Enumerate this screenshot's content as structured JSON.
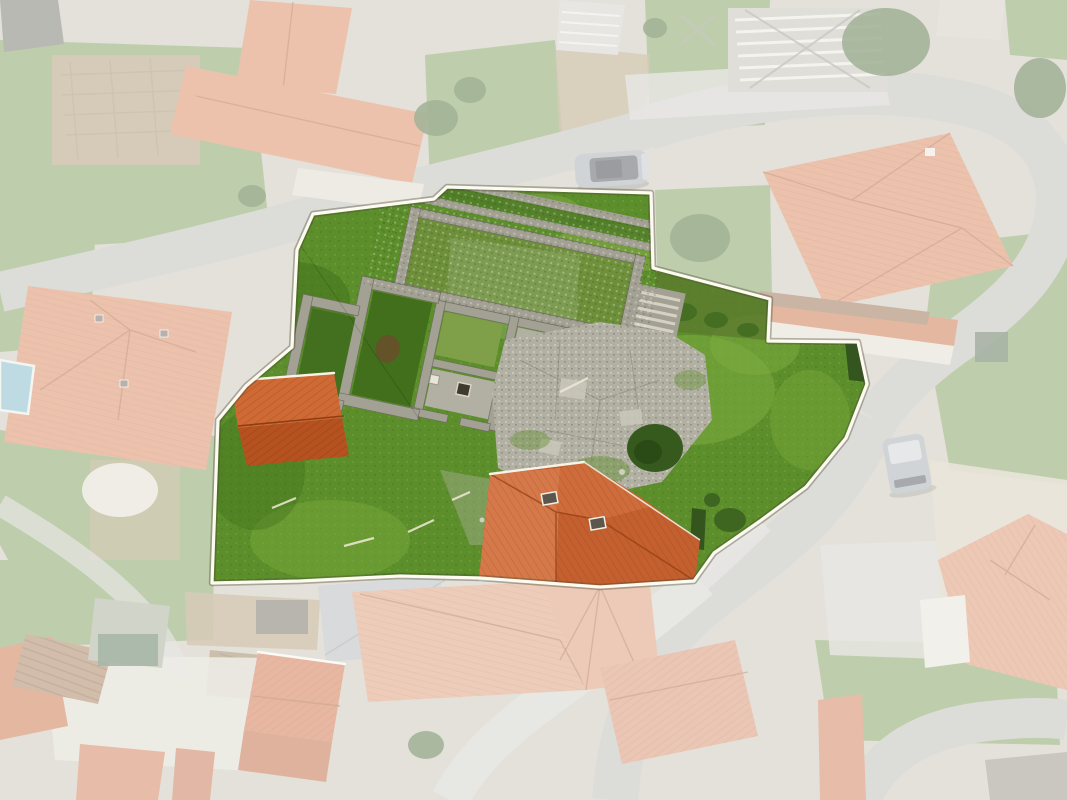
{
  "scene": {
    "type": "aerial-drone-photograph",
    "subject": "Top-down drone photo of a village; a property parcel with stone ruins and lawns is highlighted by a white boundary line while all surroundings are faded white",
    "fade_opacity": "0.55"
  },
  "parcel": {
    "outline_points": "313,214 434,199 447,187 651,193 653,268 770,299 768,341 858,342 867,384 846,438 806,487 760,521 714,553 694,581 600,587 480,578 400,576 300,581 212,583 218,420 246,386 292,347 297,250"
  },
  "objects": {
    "car": "silver car parked on upper road",
    "van": "grey van parked at right roadside",
    "ruins": "roofless stone-wall ruins with paved courtyard",
    "red_shed": "small red tiled shed roof inside parcel",
    "south_house": "red tiled house roof at parcel south edge",
    "hedges": "dark green hedges on parcel edge",
    "roads": "asphalt village roads",
    "village_roofs": "terracotta tiled village roofs (faded)",
    "fields": "grass fields, gardens and yards (faded)"
  },
  "colors": {
    "grass": "#5c8f2b",
    "grassLight": "#7dab3f",
    "grassDark": "#416f1c",
    "grassOutside": "#6f9247",
    "road": "#b2b1ac",
    "roadLight": "#cac9c3",
    "stone": "#a3a193",
    "stoneDark": "#6f6e60",
    "slab": "#b2b0a2",
    "roof": "#c4602f",
    "roofLight": "#d6794a",
    "roofDark": "#8f3d14",
    "hedge": "#35551f",
    "tree": "#2f5418",
    "dirt": "#a58d62",
    "rust": "#9c6a44",
    "pool": "#6fb0c4",
    "carBody": "#9aa0a6",
    "glass": "#3c4148",
    "boundary": "#fdfbf0",
    "baseGround": "#c2bcab",
    "fade": "#ffffff"
  }
}
